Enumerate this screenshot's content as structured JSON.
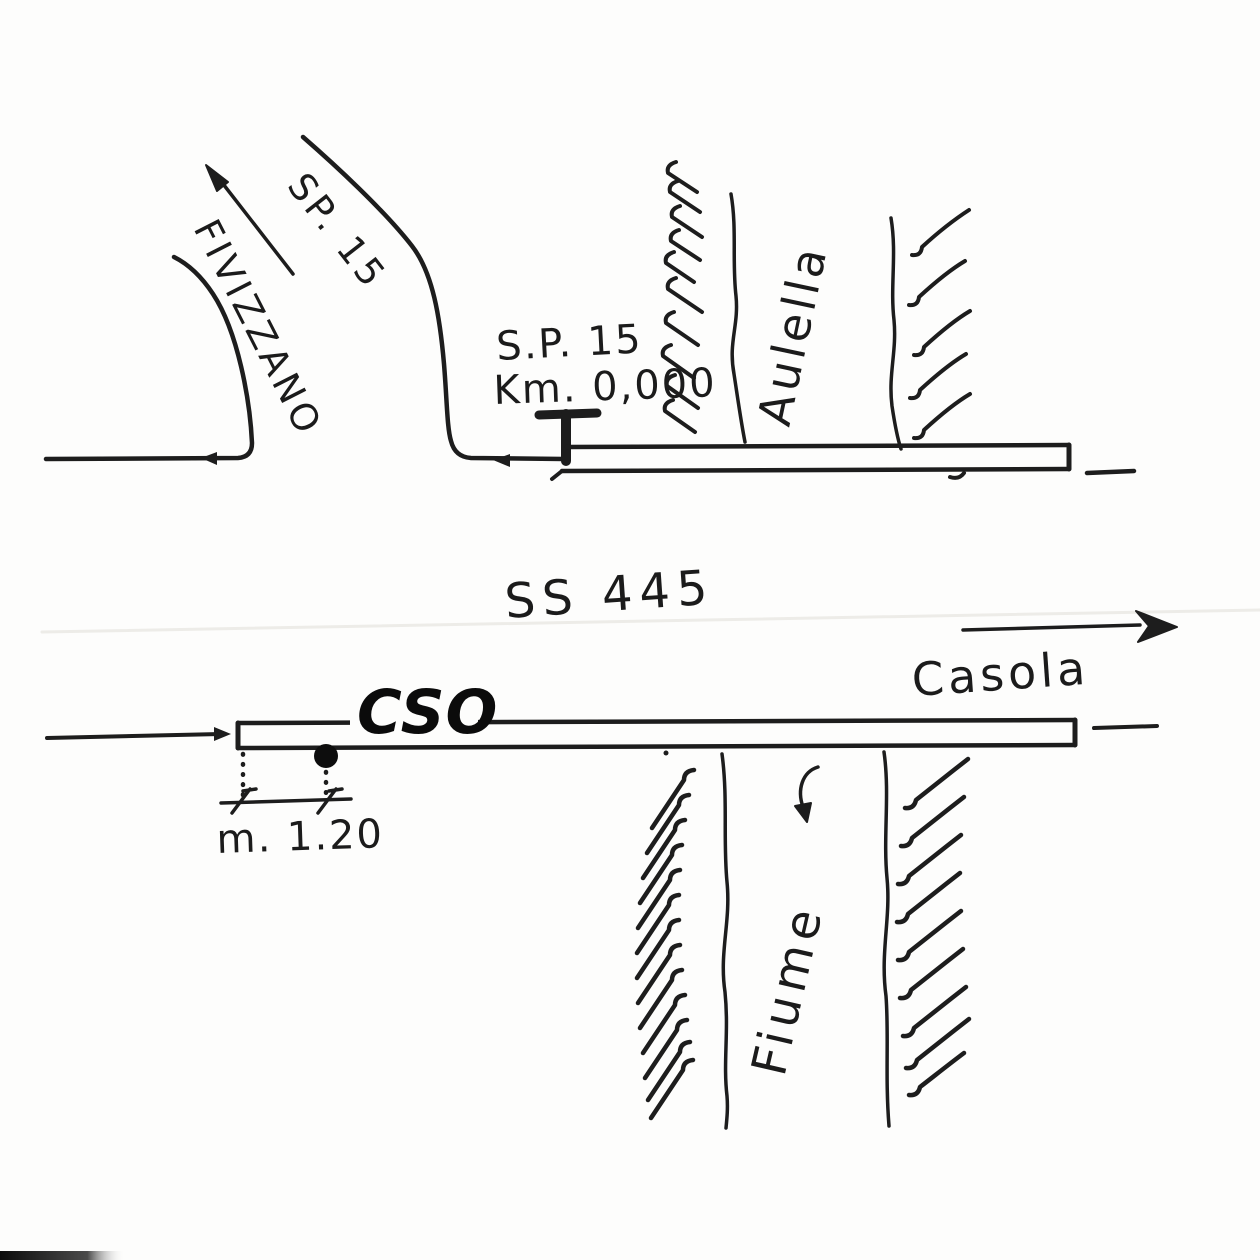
{
  "title": "Hand-drawn road location sketch",
  "colors": {
    "ink": "#1d1d1d",
    "paper": "#fdfdfc",
    "cso_text": "#0b0b0b",
    "faint_scan_line": "#edece8"
  },
  "upper": {
    "branch_destination": "FIVIZZANO",
    "branch_road": "SP. 15",
    "marker_road": "S.P. 15",
    "marker_km": "Km. 0,000",
    "river_name": "Aulella"
  },
  "lower": {
    "road_name": "SS 445",
    "direction_destination": "Casola",
    "object_label": "CSO",
    "dimension": "m. 1.20",
    "river_name": "Fiume"
  },
  "icons": {
    "branch_direction_arrow": "arrow-up-left",
    "road_direction_marker_junction": "arrow-left",
    "road_direction_marker_left": "arrow-left",
    "km_zero_marker": "T-bar-milestone",
    "casola_direction_arrow": "arrow-right",
    "lower_road_direction_marker": "arrow-right",
    "river_flow_arrow": "arrow-down",
    "cso_position_dot": "filled-circle"
  }
}
